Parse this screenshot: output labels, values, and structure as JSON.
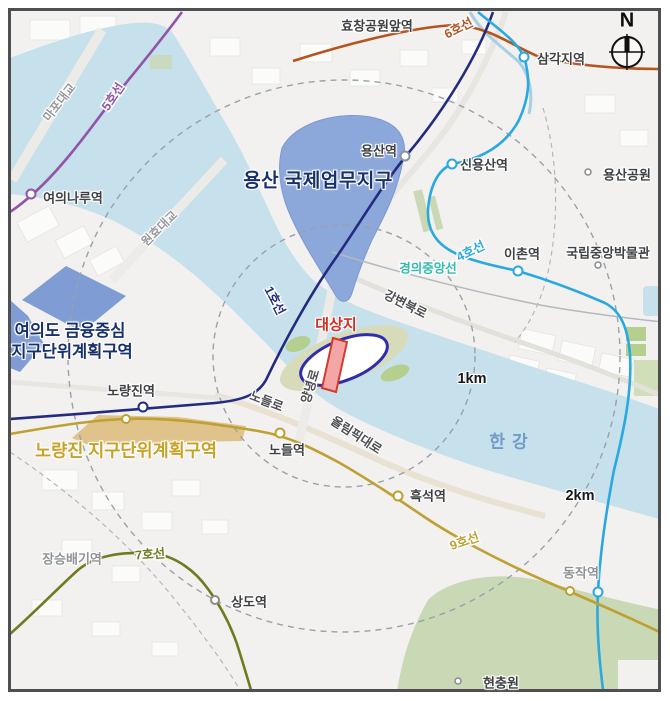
{
  "compass": {
    "letter": "N"
  },
  "distances": {
    "inner": "1km",
    "outer": "2km"
  },
  "regions": {
    "yongsan_ibd": "용산 국제업무지구",
    "yeouido_line1": "여의도 금융중심",
    "yeouido_line2": "지구단위계획구역",
    "noryangjin_district": "노량진 지구단위계획구역",
    "target_site": "대상지",
    "river": "한강"
  },
  "stations": {
    "hyochang": "효창공원앞역",
    "samgakji": "삼각지역",
    "yongsan": "용산역",
    "sinyongsan": "신용산역",
    "yongsan_park": "용산공원",
    "yeouinaru": "여의나루역",
    "ichon": "이촌역",
    "museum": "국립중앙박물관",
    "noryangjin": "노량진역",
    "nodeul": "노들역",
    "heukseok": "흑석역",
    "dongjak": "동작역",
    "sangdo": "상도역",
    "jangseungbaegi": "장승배기역",
    "hyeonchungwon": "현충원"
  },
  "bridges": {
    "mapo": "마포대교",
    "wonhyo": "원효대교"
  },
  "roads": {
    "gangbyeon": "강변북로",
    "olympic": "올림픽대로",
    "nodeul_ro": "노들로",
    "yangnyeong": "양녕로"
  },
  "lines": {
    "line1": {
      "label": "1호선",
      "color": "#232b80"
    },
    "line4": {
      "label": "4호선",
      "color": "#29a9e0"
    },
    "line5": {
      "label": "5호선",
      "color": "#9254a8"
    },
    "line6": {
      "label": "6호선",
      "color": "#b4541f"
    },
    "line7": {
      "label": "7호선",
      "color": "#6e7b1f"
    },
    "line9": {
      "label": "9호선",
      "color": "#bfa033"
    },
    "gyeongui": {
      "label": "경의중앙선",
      "color": "#2fbcad"
    }
  },
  "colors": {
    "water": "#c6e0ec",
    "land": "#f2f1ef",
    "block": "#fbfbfa",
    "ibd_fill": "#8ca7da",
    "yeouido_fill": "#7f9dd4",
    "district_tan": "#dfc38b",
    "green": "#c9d8b5",
    "green_dark": "#b5cf8e",
    "island": "#d8dbb9",
    "navy_label": "#17306b",
    "gold_label": "#c8a227",
    "red_label": "#d92b21",
    "site_outline": "#2d2db0",
    "site_band_fill": "#f2a6a6",
    "site_band_edge": "#d43a2e",
    "river_label": "#6f9bc6",
    "station_dot_gray": "#8a8a8a",
    "yongsan_dot": "#8791a8"
  }
}
